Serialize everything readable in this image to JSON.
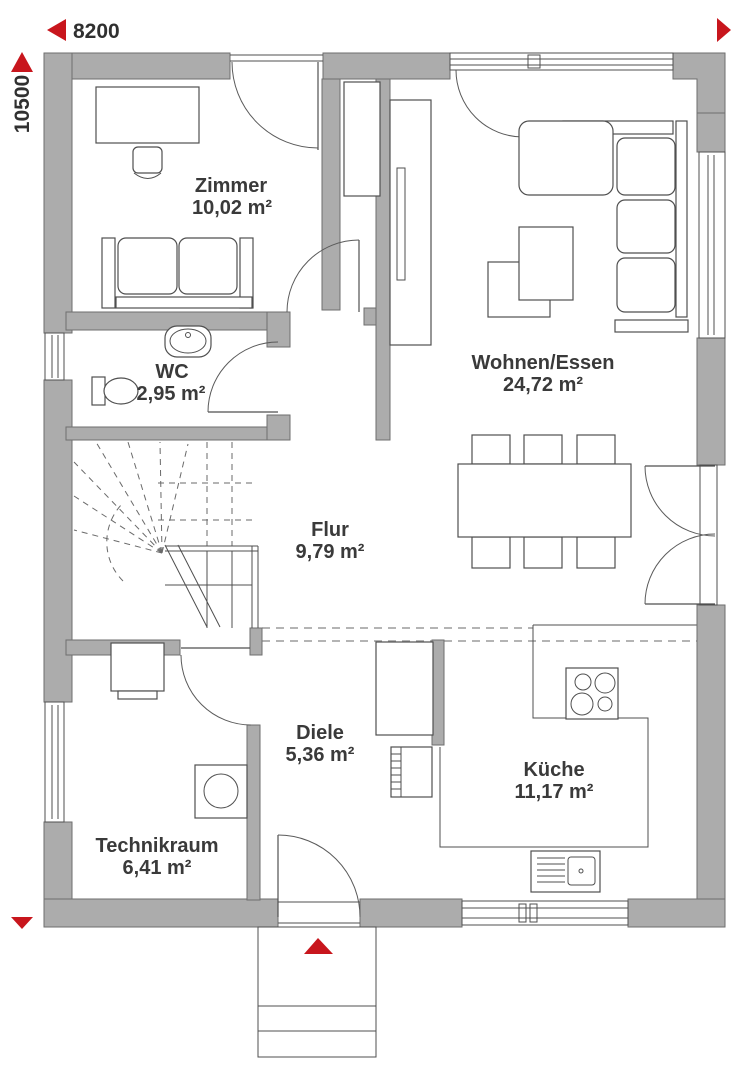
{
  "dimensions": {
    "width_label": "8200",
    "height_label": "10500"
  },
  "rooms": [
    {
      "id": "zimmer",
      "name": "Zimmer",
      "area": "10,02 m²"
    },
    {
      "id": "wc",
      "name": "WC",
      "area": "2,95 m²"
    },
    {
      "id": "wohnen",
      "name": "Wohnen/Essen",
      "area": "24,72 m²"
    },
    {
      "id": "flur",
      "name": "Flur",
      "area": "9,79 m²"
    },
    {
      "id": "diele",
      "name": "Diele",
      "area": "5,36 m²"
    },
    {
      "id": "technikraum",
      "name": "Technikraum",
      "area": "6,41 m²"
    },
    {
      "id": "kueche",
      "name": "Küche",
      "area": "11,17 m²"
    }
  ],
  "icons": {
    "width_arrow_left": "triangle-left",
    "width_arrow_right": "triangle-right",
    "height_arrow_top": "triangle-up",
    "height_arrow_bottom": "triangle-down",
    "entrance_marker": "triangle-up"
  },
  "colors": {
    "wall_fill": "#acacac",
    "wall_stroke": "#6e6e6e",
    "line": "#4f4f4f",
    "dashed_ceiling": "#9b9b9b",
    "accent_red": "#c8161d",
    "text": "#3a3a3a",
    "background": "#ffffff"
  }
}
